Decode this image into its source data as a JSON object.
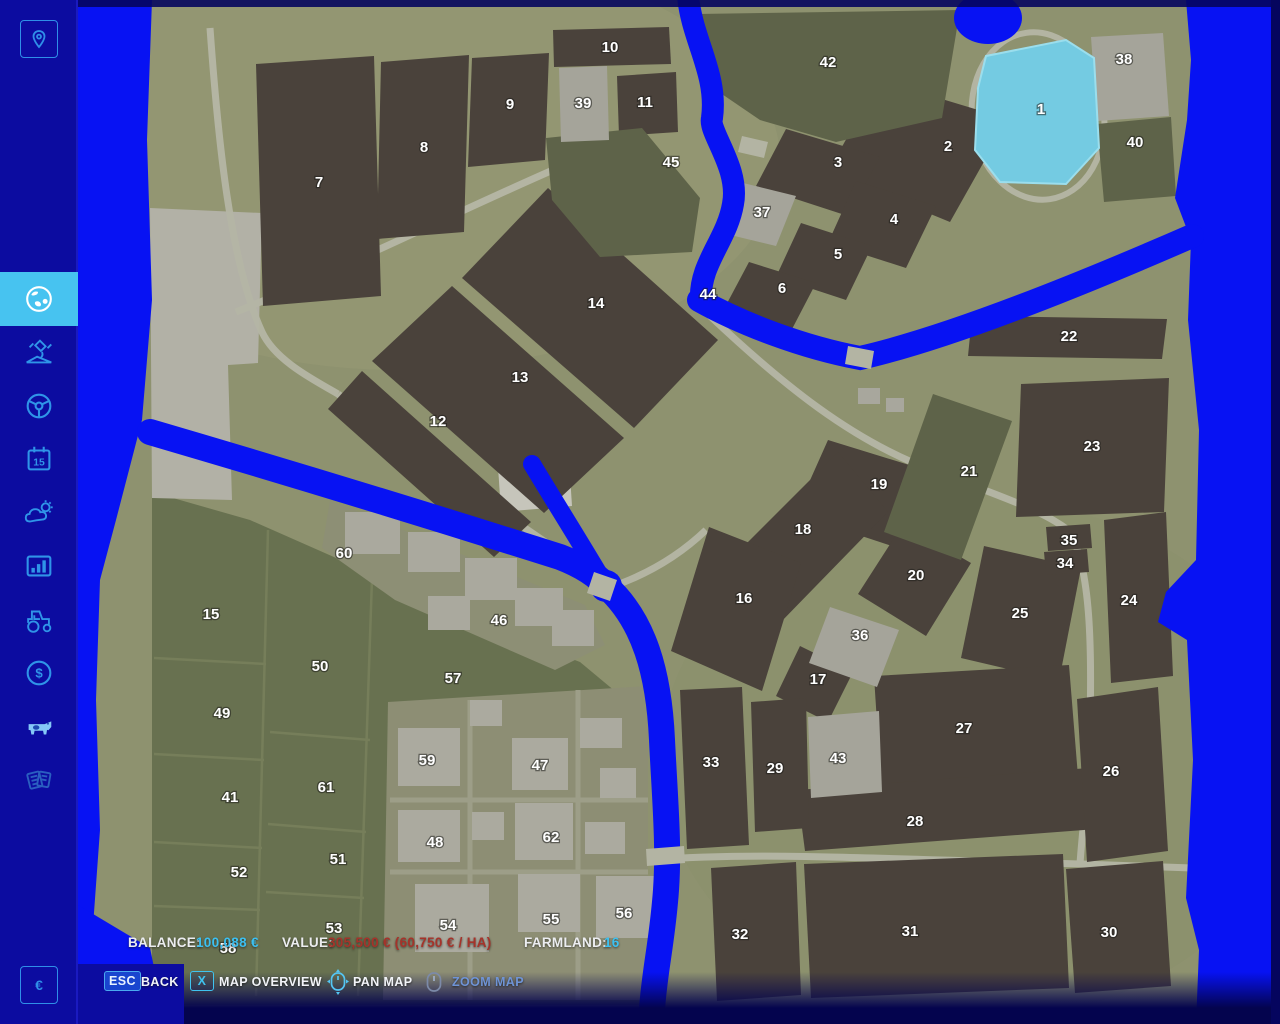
{
  "title": "Farmland Map Overview",
  "sidebar": {
    "top_button_icon": "map-marker-icon",
    "items": [
      {
        "icon": "globe-icon",
        "active": true
      },
      {
        "icon": "satellite-icon",
        "active": false
      },
      {
        "icon": "steering-wheel-icon",
        "active": false
      },
      {
        "icon": "calendar-icon",
        "active": false
      },
      {
        "icon": "weather-icon",
        "active": false
      },
      {
        "icon": "statistics-icon",
        "active": false
      },
      {
        "icon": "tractor-icon",
        "active": false
      },
      {
        "icon": "finances-icon",
        "active": false
      },
      {
        "icon": "animals-icon",
        "active": false
      },
      {
        "icon": "contracts-icon",
        "active": false
      }
    ],
    "calendar_day": "15",
    "finance_symbol": "$",
    "currency_symbol": "€"
  },
  "statusbar": {
    "balance_label": "BALANCE:",
    "balance_value": "100,088 €",
    "value_label": "VALUE:",
    "value_value": "305,500 € (60,750 € / HA)",
    "farmland_label": "FARMLAND:",
    "farmland_value": "16"
  },
  "controls": {
    "back_key": "ESC",
    "back_label": "BACK",
    "overview_key": "X",
    "overview_label": "MAP OVERVIEW",
    "pan_icon": "mouse-pan-icon",
    "pan_label": "PAN MAP",
    "zoom_icon": "mouse-zoom-icon",
    "zoom_label": "ZOOM MAP"
  },
  "colors": {
    "accent_cyan": "#3fc3f0",
    "balance_value": "#3cc0f1",
    "value_red": "#a5332a",
    "sidebar_bg": "#0c0ca0",
    "active_item_bg": "#47c3f0",
    "water": "#0712f3",
    "lake": "#74cbe2",
    "land": "#8e926f",
    "field_dark": "#4a423b"
  },
  "map": {
    "fields": [
      {
        "n": "1",
        "x": 1041,
        "y": 109
      },
      {
        "n": "2",
        "x": 948,
        "y": 146
      },
      {
        "n": "3",
        "x": 838,
        "y": 162
      },
      {
        "n": "4",
        "x": 894,
        "y": 219
      },
      {
        "n": "5",
        "x": 838,
        "y": 254
      },
      {
        "n": "6",
        "x": 782,
        "y": 288
      },
      {
        "n": "7",
        "x": 319,
        "y": 182
      },
      {
        "n": "8",
        "x": 424,
        "y": 147
      },
      {
        "n": "9",
        "x": 510,
        "y": 104
      },
      {
        "n": "10",
        "x": 610,
        "y": 47
      },
      {
        "n": "11",
        "x": 645,
        "y": 102
      },
      {
        "n": "12",
        "x": 438,
        "y": 421
      },
      {
        "n": "13",
        "x": 520,
        "y": 377
      },
      {
        "n": "14",
        "x": 596,
        "y": 303
      },
      {
        "n": "15",
        "x": 211,
        "y": 614
      },
      {
        "n": "16",
        "x": 744,
        "y": 598
      },
      {
        "n": "17",
        "x": 818,
        "y": 679
      },
      {
        "n": "18",
        "x": 803,
        "y": 529
      },
      {
        "n": "19",
        "x": 879,
        "y": 484
      },
      {
        "n": "20",
        "x": 916,
        "y": 575
      },
      {
        "n": "21",
        "x": 969,
        "y": 471
      },
      {
        "n": "22",
        "x": 1069,
        "y": 336
      },
      {
        "n": "23",
        "x": 1092,
        "y": 446
      },
      {
        "n": "24",
        "x": 1129,
        "y": 600
      },
      {
        "n": "25",
        "x": 1020,
        "y": 613
      },
      {
        "n": "26",
        "x": 1111,
        "y": 771
      },
      {
        "n": "27",
        "x": 964,
        "y": 728
      },
      {
        "n": "28",
        "x": 915,
        "y": 821
      },
      {
        "n": "29",
        "x": 775,
        "y": 768
      },
      {
        "n": "30",
        "x": 1109,
        "y": 932
      },
      {
        "n": "31",
        "x": 910,
        "y": 931
      },
      {
        "n": "32",
        "x": 740,
        "y": 934
      },
      {
        "n": "33",
        "x": 711,
        "y": 762
      },
      {
        "n": "34",
        "x": 1065,
        "y": 563
      },
      {
        "n": "35",
        "x": 1069,
        "y": 540
      },
      {
        "n": "36",
        "x": 860,
        "y": 635
      },
      {
        "n": "37",
        "x": 762,
        "y": 212
      },
      {
        "n": "38",
        "x": 1124,
        "y": 59
      },
      {
        "n": "39",
        "x": 583,
        "y": 103
      },
      {
        "n": "40",
        "x": 1135,
        "y": 142
      },
      {
        "n": "41",
        "x": 230,
        "y": 797
      },
      {
        "n": "42",
        "x": 828,
        "y": 62
      },
      {
        "n": "43",
        "x": 838,
        "y": 758
      },
      {
        "n": "44",
        "x": 708,
        "y": 294
      },
      {
        "n": "45",
        "x": 671,
        "y": 162
      },
      {
        "n": "46",
        "x": 499,
        "y": 620
      },
      {
        "n": "47",
        "x": 540,
        "y": 765
      },
      {
        "n": "48",
        "x": 435,
        "y": 842
      },
      {
        "n": "49",
        "x": 222,
        "y": 713
      },
      {
        "n": "50",
        "x": 320,
        "y": 666
      },
      {
        "n": "51",
        "x": 338,
        "y": 859
      },
      {
        "n": "52",
        "x": 239,
        "y": 872
      },
      {
        "n": "53",
        "x": 334,
        "y": 928
      },
      {
        "n": "54",
        "x": 448,
        "y": 925
      },
      {
        "n": "55",
        "x": 551,
        "y": 919
      },
      {
        "n": "56",
        "x": 624,
        "y": 913
      },
      {
        "n": "57",
        "x": 453,
        "y": 678
      },
      {
        "n": "58",
        "x": 228,
        "y": 948
      },
      {
        "n": "59",
        "x": 427,
        "y": 760
      },
      {
        "n": "60",
        "x": 344,
        "y": 553
      },
      {
        "n": "61",
        "x": 326,
        "y": 787
      },
      {
        "n": "62",
        "x": 551,
        "y": 837
      }
    ]
  }
}
